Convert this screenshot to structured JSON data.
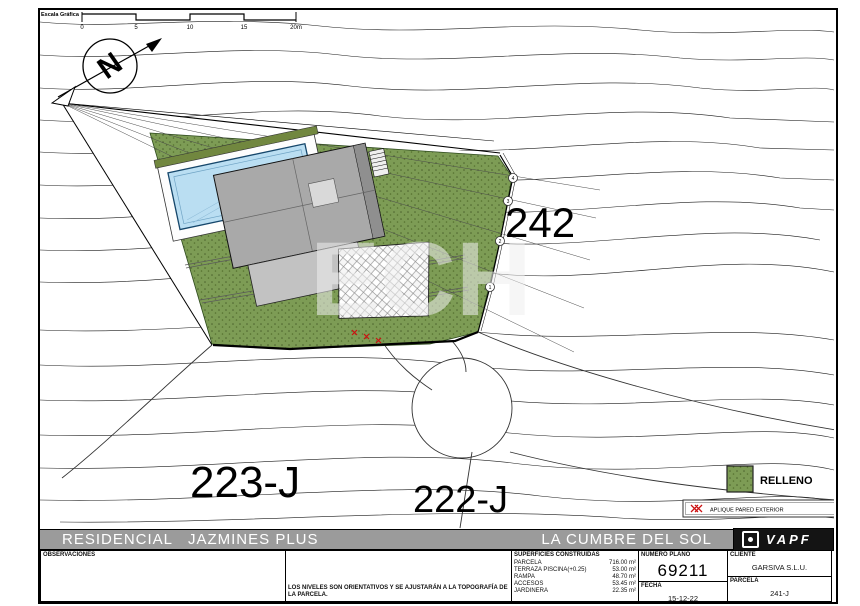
{
  "plan": {
    "scale": {
      "title": "Escala Gráfica",
      "ticks": [
        "0",
        "5",
        "10",
        "15",
        "20m"
      ]
    },
    "plots": {
      "right": "242",
      "bottom_left": "223-J",
      "bottom_center": "222-J"
    },
    "markers": [
      "4",
      "3",
      "2",
      "1"
    ],
    "pool": {
      "line1": "PISCINA A DESBORD.",
      "line2": "NIVEL +0.25"
    },
    "watermark": "ECH"
  },
  "legend": {
    "relleno": "RELLENO",
    "aplique": "APLIQUE PARED EXTERIOR"
  },
  "titlebar": {
    "left": "RESIDENCIAL   JAZMINES PLUS",
    "right": "LA CUMBRE DEL SOL",
    "logo": "VAPF"
  },
  "titleblock": {
    "observaciones_label": "OBSERVACIONES",
    "levels_note": "LOS NIVELES SON ORIENTATIVOS Y SE AJUSTARÁN A LA TOPOGRAFÍA DE LA PARCELA.",
    "surfaces_title": "SUPERFICIES CONSTRUIDAS",
    "surfaces": [
      {
        "name": "PARCELA",
        "value": "716.00 m²"
      },
      {
        "name": "TERRAZA PISCINA(+0.25)",
        "value": "53.00 m²"
      },
      {
        "name": "RAMPA",
        "value": "48.70 m²"
      },
      {
        "name": "ACCESOS",
        "value": "53.45 m²"
      },
      {
        "name": "JARDINERA",
        "value": "22.35 m²"
      }
    ],
    "numero_plano_label": "NUMERO PLANO",
    "numero_plano": "69211",
    "fecha_label": "FECHA",
    "fecha": "15-12-22",
    "cliente_label": "CLIENTE",
    "cliente": "GARSIVA S.L.U.",
    "parcela_label": "PARCELA",
    "parcela": "241-J"
  },
  "colors": {
    "relleno": "#7d9c55",
    "pool": "#badef2",
    "band_gray": "#9b9b9b",
    "red": "#cc1111"
  }
}
